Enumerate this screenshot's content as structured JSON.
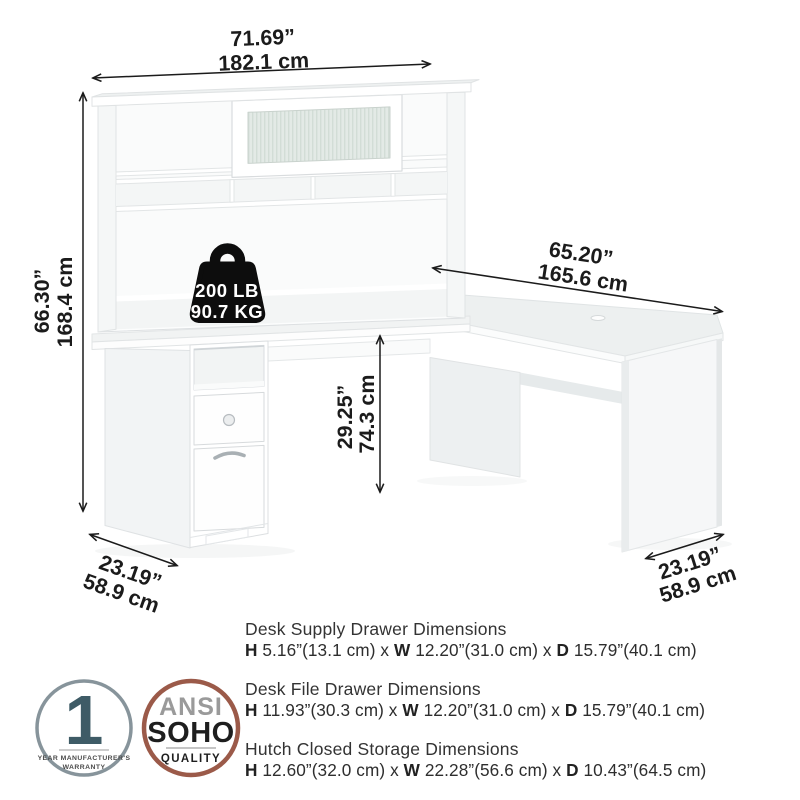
{
  "page": {
    "background": "#ffffff"
  },
  "product": {
    "illustration": "l-shaped-desk-with-hutch",
    "weight_capacity": {
      "lb": "200 LB",
      "kg": "90.7 KG"
    }
  },
  "annotations": {
    "overall_width": {
      "inches": "71.69”",
      "cm": "182.1 cm"
    },
    "overall_height": {
      "inches": "66.30”",
      "cm": "168.4 cm"
    },
    "return_length": {
      "inches": "65.20”",
      "cm": "165.6 cm"
    },
    "desk_surface_height": {
      "inches": "29.25”",
      "cm": "74.3 cm"
    },
    "left_depth": {
      "inches": "23.19”",
      "cm": "58.9 cm"
    },
    "right_depth": {
      "inches": "23.19”",
      "cm": "58.9 cm"
    }
  },
  "specs": [
    {
      "title": "Desk Supply Drawer Dimensions",
      "h_label": "H",
      "h_value": " 5.16”(13.1 cm) x ",
      "w_label": "W",
      "w_value": " 12.20”(31.0 cm) x ",
      "d_label": "D",
      "d_value": " 15.79”(40.1 cm)"
    },
    {
      "title": "Desk File Drawer Dimensions",
      "h_label": "H",
      "h_value": " 11.93”(30.3 cm) x ",
      "w_label": "W",
      "w_value": " 12.20”(31.0 cm) x ",
      "d_label": "D",
      "d_value": " 15.79”(40.1 cm)"
    },
    {
      "title": "Hutch Closed Storage Dimensions",
      "h_label": "H",
      "h_value": " 12.60”(32.0 cm) x ",
      "w_label": "W",
      "w_value": " 22.28”(56.6 cm) x ",
      "d_label": "D",
      "d_value": " 10.43”(64.5 cm)"
    }
  ],
  "badges": {
    "warranty": {
      "number": "1",
      "line1": "YEAR MANUFACTURER'S",
      "line2": "WARRANTY"
    },
    "quality": {
      "line1": "ANSI",
      "line2": "SOHO",
      "line3": "QUALITY"
    }
  },
  "colors": {
    "dimension_text": "#1b1b1b",
    "warranty_ring": "#87949b",
    "warranty_number": "#3e5b66",
    "quality_ring": "#9b5a49",
    "glass_tint": "#e3eae6"
  }
}
